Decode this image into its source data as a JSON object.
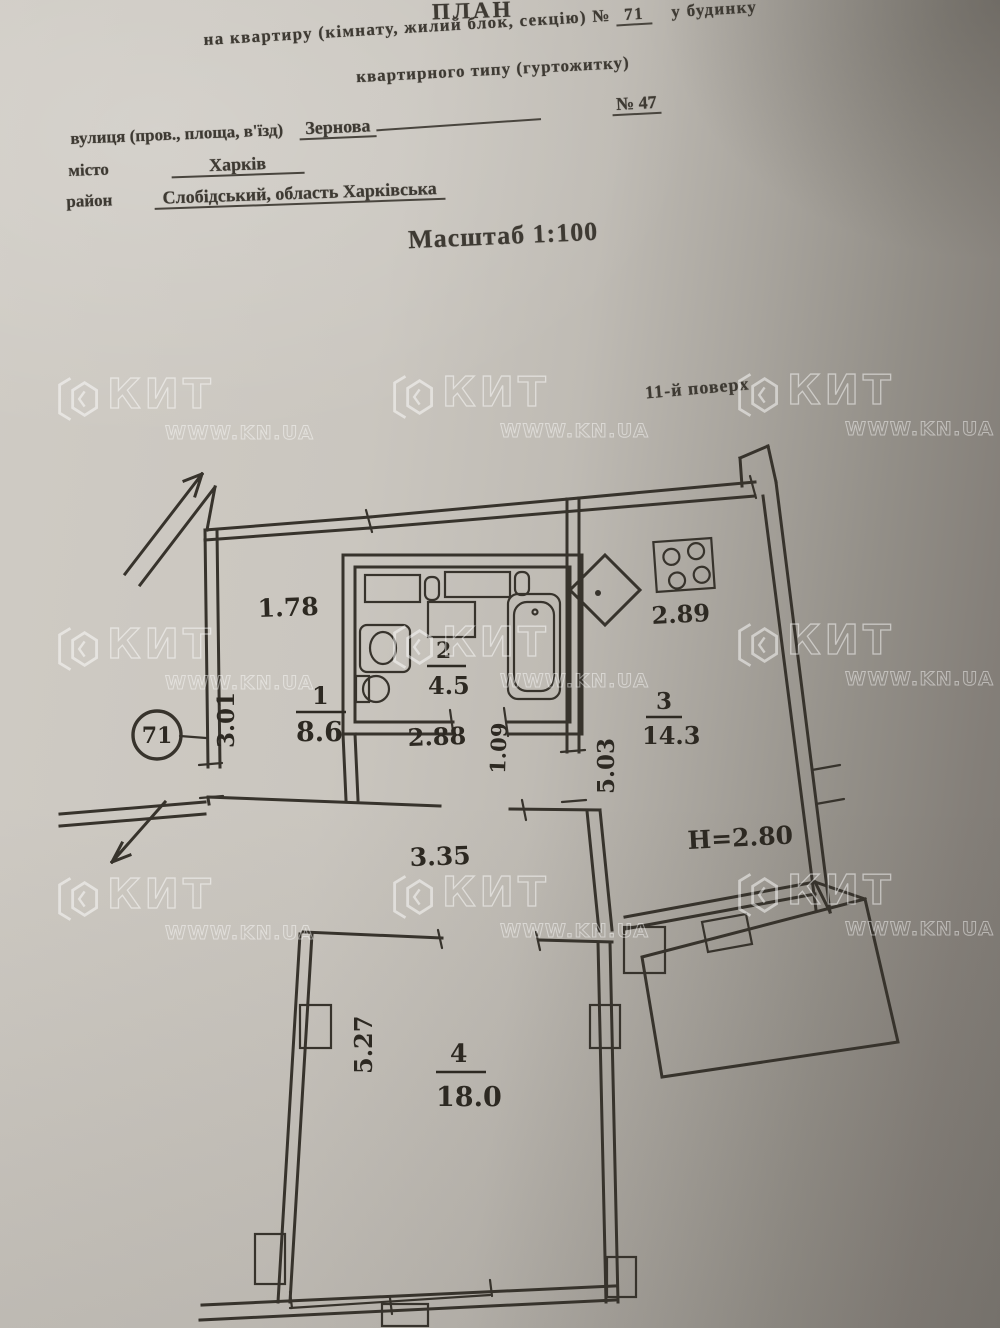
{
  "document": {
    "title": "ПЛАН",
    "subtitle_prefix": "на квартиру (кімнату, жилий блок, секцію) №",
    "apartment_no": "71",
    "subtitle_suffix": "у будинку",
    "subtitle_line2": "квартирного типу (гуртожитку)",
    "building_no": "№ 47",
    "street_label": "вулиця (пров., площа, в'їзд)",
    "street_value": "Зернова",
    "city_label": "місто",
    "city_value": "Харків",
    "district_label": "район",
    "district_value": "Слобідський, область Харківська",
    "scale": "Масштаб 1:100",
    "floor_note": "11-й поверх"
  },
  "watermark": {
    "brand": "КИТ",
    "url": "WWW.KN.UA"
  },
  "plan": {
    "apartment_circle": "71",
    "labels": {
      "r1_width": "1.78",
      "r1_depth": "3.01",
      "r1_num": "1",
      "r1_area": "8.6",
      "r2_num": "2",
      "r2_area": "4.5",
      "r2_width": "2.88",
      "r2_door": "1.09",
      "r3_num": "3",
      "r3_area": "14.3",
      "r3_width": "2.89",
      "r3_depth": "5.03",
      "ceiling_height": "Н=2.80",
      "hall_width": "3.35",
      "r4_num": "4",
      "r4_area": "18.0",
      "r4_depth": "5.27"
    }
  }
}
